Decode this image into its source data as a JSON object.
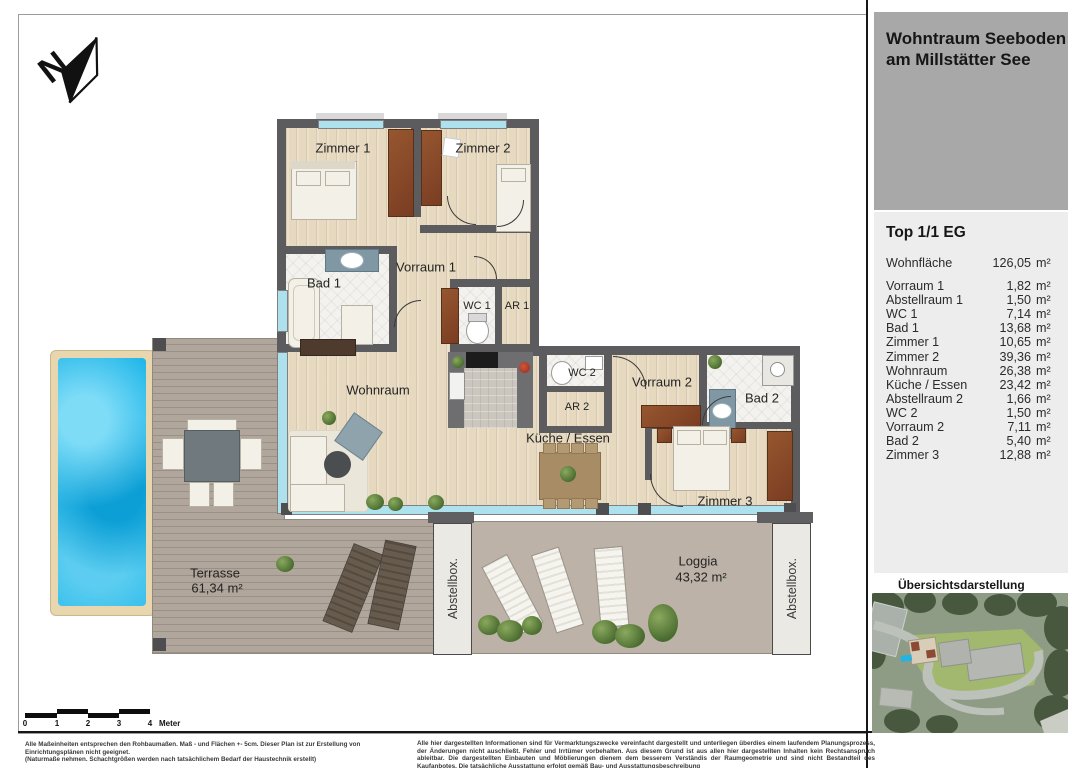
{
  "header": {
    "title_line1": "Wohntraum Seeboden",
    "title_line2": "am Millstätter See"
  },
  "unit": {
    "heading": "Top 1/1 EG",
    "total_label": "Wohnfläche",
    "total_value": "126,05",
    "unit": "m²",
    "rooms": [
      {
        "label": "Vorraum 1",
        "value": "1,82"
      },
      {
        "label": "Abstellraum 1",
        "value": "1,50"
      },
      {
        "label": "WC 1",
        "value": "7,14"
      },
      {
        "label": "Bad 1",
        "value": "13,68"
      },
      {
        "label": "Zimmer 1",
        "value": "10,65"
      },
      {
        "label": "Zimmer 2",
        "value": "39,36"
      },
      {
        "label": "Wohnraum",
        "value": "26,38"
      },
      {
        "label": "Küche / Essen",
        "value": "23,42"
      },
      {
        "label": "Abstellraum 2",
        "value": "1,66"
      },
      {
        "label": "WC 2",
        "value": "1,50"
      },
      {
        "label": "Vorraum 2",
        "value": "7,11"
      },
      {
        "label": "Bad 2",
        "value": "5,40"
      },
      {
        "label": "Zimmer 3",
        "value": "12,88"
      }
    ]
  },
  "overview": {
    "label": "Übersichtsdarstellung"
  },
  "plan": {
    "north": "N",
    "labels": {
      "zimmer1": "Zimmer 1",
      "zimmer2": "Zimmer 2",
      "bad1": "Bad 1",
      "vorraum1": "Vorraum 1",
      "wc1": "WC 1",
      "ar1": "AR 1",
      "wohnraum": "Wohnraum",
      "wc2": "WC 2",
      "ar2": "AR 2",
      "vorraum2": "Vorraum 2",
      "bad2": "Bad 2",
      "kueche": "Küche / Essen",
      "zimmer3": "Zimmer 3"
    },
    "terrasse_label": "Terrasse",
    "terrasse_area": "61,34 m²",
    "loggia_label": "Loggia",
    "loggia_area": "43,32 m²",
    "abstellbox": "Abstellbox."
  },
  "scalebar": {
    "ticks": [
      "0",
      "1",
      "2",
      "3",
      "4"
    ],
    "unit_label": "Meter"
  },
  "footnotes": {
    "left_line1": "Alle Maßeinheiten entsprechen den Rohbaumaßen.  Maß - und Flächen +- 5cm. Dieser Plan ist zur Erstellung von Einrichtungsplänen nicht geeignet.",
    "left_line2": "(Naturmaße nehmen. Schachtgrößen werden nach tatsächlichem Bedarf der Haustechnik erstellt)",
    "right": "Alle hier dargestellten Informationen sind für Vermarktungszwecke vereinfacht dargestellt und unterliegen überdies einem laufendem Planungsprozess, der Änderungen nicht auschließt. Fehler und Irrtümer vorbehalten. Aus diesem Grund ist aus allen hier dargestellten Inhalten kein Rechtsanspruch ableitbar. Die dargestellten Einbauten und Möblierungen dienem dem besserem Verständis der Raumgeometrie und sind nicht Bestandteil des Kaufanbotes. Die tatsächliche Ausstattung erfolgt gemäß Bau- und Ausstattungsbeschreibung"
  },
  "colors": {
    "wall": "#5c5c5e",
    "pool": "#1ab4e8",
    "window": "#aee1ee",
    "header_gray": "#a8a8a8"
  }
}
